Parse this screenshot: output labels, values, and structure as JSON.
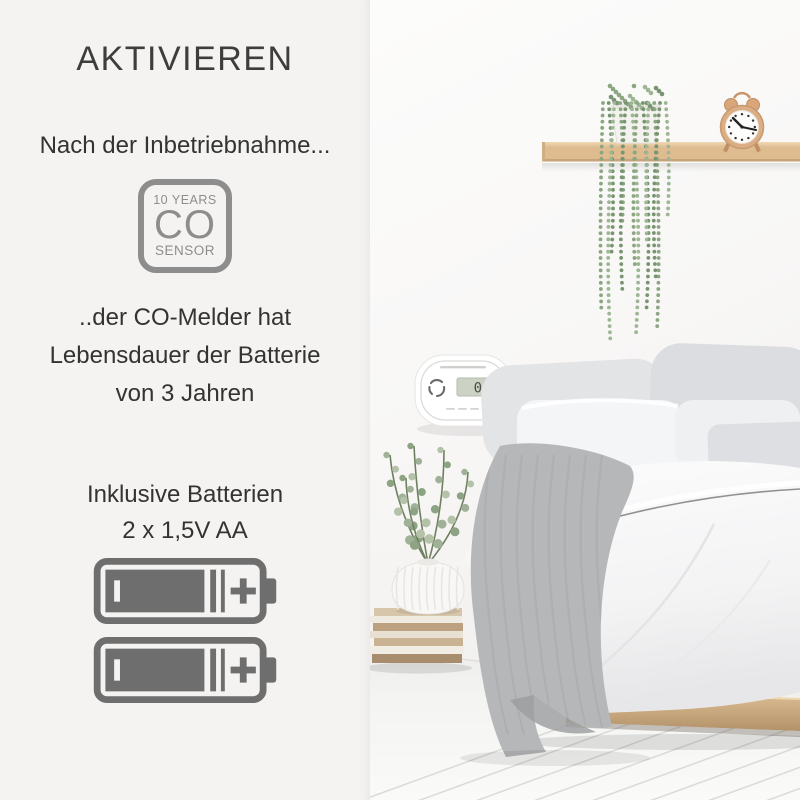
{
  "panel": {
    "title": "AKTIVIEREN",
    "intro": "Nach der Inbetriebnahme...",
    "sensor_badge": {
      "line1": "10 YEARS",
      "line2": "CO",
      "line3": "SENSOR"
    },
    "body_lines": [
      "..der CO-Melder hat",
      "Lebensdauer der Batterie",
      "von 3 Jahren"
    ],
    "battery_note_lines": [
      "Inklusive Batterien",
      "2 x 1,5V AA"
    ]
  },
  "detector": {
    "display_value": "0"
  },
  "colors": {
    "panel_bg": "#f4f3f1",
    "text_dark": "#3a3a3a",
    "badge_gray": "#8d8d8d",
    "battery_gray": "#6e6e6e",
    "lcd_green": "#ccd3c5",
    "shelf_wood": "#debc90",
    "clock_copper": "#dcae85",
    "plant_green": "#8ba681"
  }
}
